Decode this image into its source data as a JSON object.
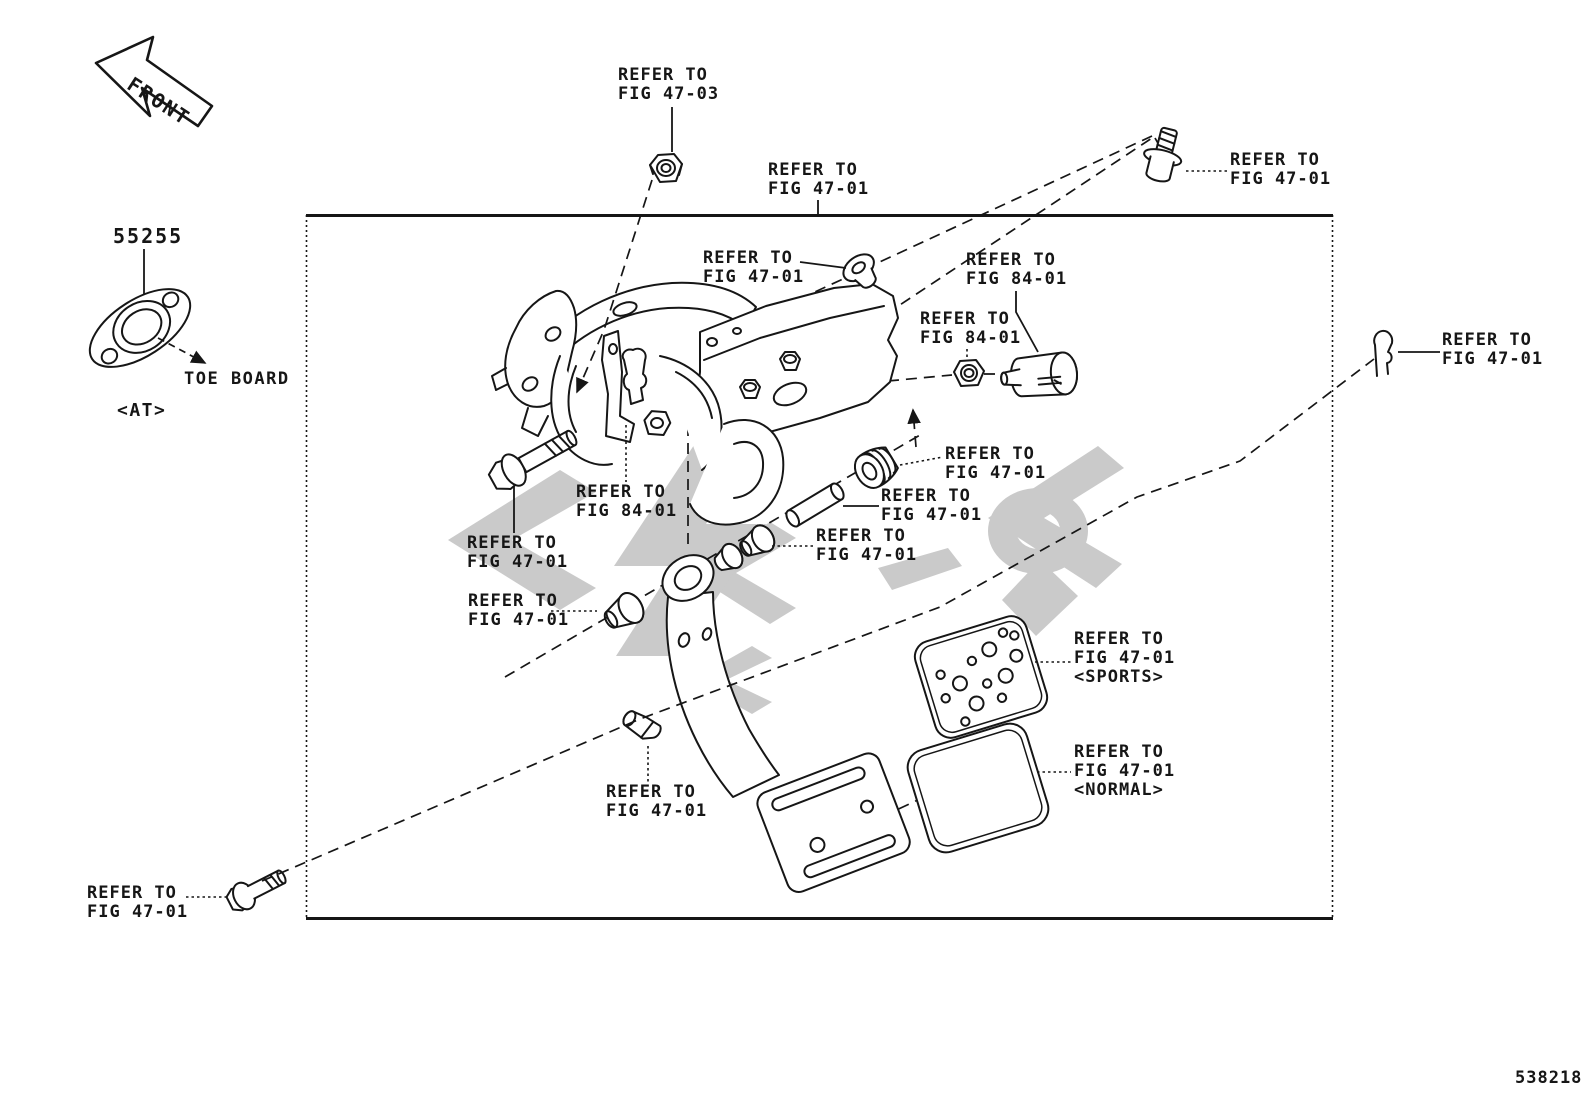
{
  "labels": {
    "front": "FRONT",
    "part_number": "55255",
    "toe_board": "TOE BOARD",
    "transmission_variant": "<AT>",
    "figure_code": "538218"
  },
  "colors": {
    "line": "#161616",
    "watermark": "#cacaca",
    "background": "#ffffff"
  },
  "callouts": [
    {
      "target": "lock-nut-top",
      "lines": [
        "REFER TO",
        "FIG 47-03"
      ]
    },
    {
      "target": "pedal-bracket-assembly",
      "lines": [
        "REFER TO",
        "FIG 47-01"
      ]
    },
    {
      "target": "mount-bolt-upper",
      "lines": [
        "REFER TO",
        "FIG 47-01"
      ]
    },
    {
      "target": "snap-pin-right",
      "lines": [
        "REFER TO",
        "FIG 47-01"
      ]
    },
    {
      "target": "grommet",
      "lines": [
        "REFER TO",
        "FIG 47-01"
      ]
    },
    {
      "target": "stop-lamp-switch",
      "lines": [
        "REFER TO",
        "FIG 84-01"
      ]
    },
    {
      "target": "switch-nut",
      "lines": [
        "REFER TO",
        "FIG 84-01"
      ]
    },
    {
      "target": "clevis",
      "lines": [
        "REFER TO",
        "FIG 84-01"
      ]
    },
    {
      "target": "pivot-bolt",
      "lines": [
        "REFER TO",
        "FIG 47-01"
      ]
    },
    {
      "target": "grooved-bushing",
      "lines": [
        "REFER TO",
        "FIG 47-01"
      ]
    },
    {
      "target": "pivot-pin",
      "lines": [
        "REFER TO",
        "FIG 47-01"
      ]
    },
    {
      "target": "bushing-upper",
      "lines": [
        "REFER TO",
        "FIG 47-01"
      ]
    },
    {
      "target": "bushing-lower",
      "lines": [
        "REFER TO",
        "FIG 47-01"
      ]
    },
    {
      "target": "pedal-clip",
      "lines": [
        "REFER TO",
        "FIG 47-01"
      ]
    },
    {
      "target": "pedal-pad-sports",
      "lines": [
        "REFER TO",
        "FIG 47-01",
        "<SPORTS>"
      ]
    },
    {
      "target": "pedal-pad-normal",
      "lines": [
        "REFER TO",
        "FIG 47-01",
        "<NORMAL>"
      ]
    },
    {
      "target": "mount-bolt-lower",
      "lines": [
        "REFER TO",
        "FIG 47-01"
      ]
    }
  ]
}
